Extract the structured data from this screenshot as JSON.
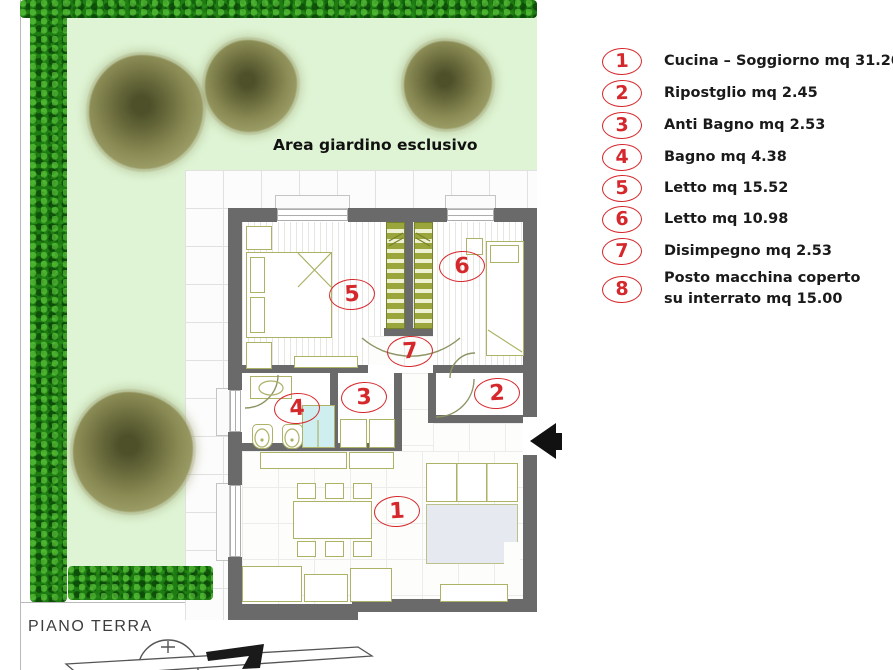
{
  "plan_title": "PIANO TERRA",
  "garden_label": "Area giardino esclusivo",
  "legend": {
    "items": [
      {
        "num": "1",
        "label": "Cucina – Soggiorno mq 31.20"
      },
      {
        "num": "2",
        "label": "Ripostglio mq 2.45"
      },
      {
        "num": "3",
        "label": "Anti Bagno mq 2.53"
      },
      {
        "num": "4",
        "label": "Bagno mq 4.38"
      },
      {
        "num": "5",
        "label": "Letto  mq 15.52"
      },
      {
        "num": "6",
        "label": "Letto mq 10.98"
      },
      {
        "num": "7",
        "label": "Disimpegno mq 2.53"
      },
      {
        "num": "8",
        "label": "Posto macchina coperto",
        "label2": "su interrato mq 15.00"
      }
    ]
  },
  "plan": {
    "room_labels": [
      "1",
      "2",
      "3",
      "4",
      "5",
      "6",
      "7"
    ]
  },
  "colors": {
    "accent_red": "#d5282c",
    "garden_green": "#def4d4",
    "hedge_green": "#1e7c12",
    "wall_gray": "#6a6a6a",
    "furniture_olive": "#adb266",
    "wardrobe_green": "#9aa63b",
    "shower_cyan": "#cfeef0",
    "sofa_gray": "#e7e9f0",
    "tree_olive": "#8e8f58"
  }
}
